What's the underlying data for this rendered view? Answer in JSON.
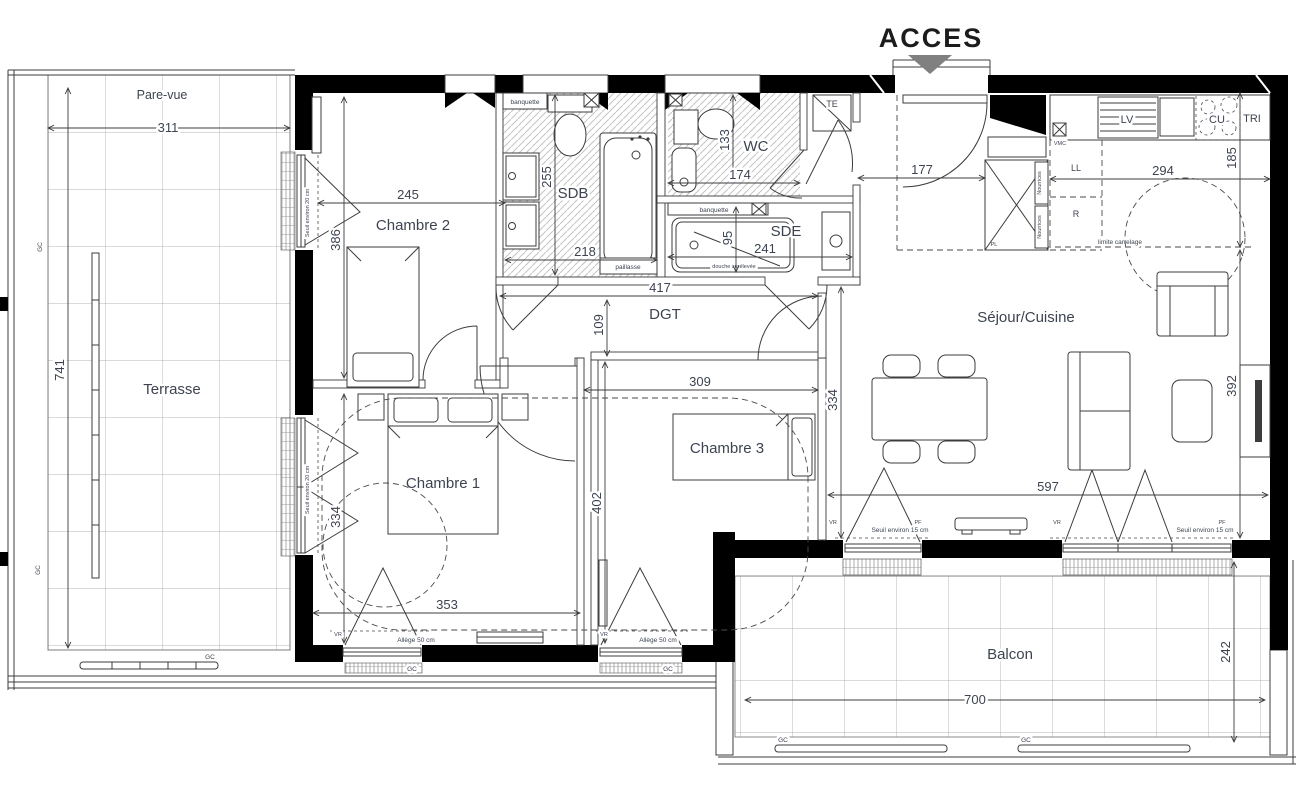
{
  "header": {
    "acces": "ACCES"
  },
  "colors": {
    "wall": "#000000",
    "text": "#3d4450",
    "access_arrow": "#808080",
    "lines": "#3c3c3c"
  },
  "rooms": {
    "pare_vue": "Pare-vue",
    "terrasse": "Terrasse",
    "chambre1": "Chambre 1",
    "chambre2": "Chambre 2",
    "chambre3": "Chambre 3",
    "sdb": "SDB",
    "wc": "WC",
    "sde": "SDE",
    "dgt": "DGT",
    "sejour": "Séjour/Cuisine",
    "balcon": "Balcon"
  },
  "kitchen": {
    "lv": "LV",
    "cu": "CU",
    "tri": "TRI",
    "ll": "LL",
    "r": "R",
    "pl": "PL",
    "te": "TE",
    "vmc": "VMC",
    "nourrices": "Nourrices",
    "limite_carrelage": "limite carrelage"
  },
  "bath": {
    "banquette": "banquette",
    "paillasse": "paillasse",
    "douche_surelevee": "douche surélevée"
  },
  "annotations": {
    "seuil_15": "Seuil environ 15 cm",
    "seuil_20": "Seuil environ 20 cm",
    "allege_50": "Allège 50 cm",
    "vr": "VR",
    "pf": "PF",
    "gc": "GC"
  },
  "dims": {
    "pare_vue_w": "311",
    "terrasse_h": "741",
    "ch2_w": "245",
    "ch2_h": "386",
    "sdb_h": "255",
    "sdb_w": "218",
    "wc_h": "133",
    "wc_w": "174",
    "entree_w": "177",
    "cuisine_w": "294",
    "cuisine_h": "185",
    "sde_h": "95",
    "sde_w": "241",
    "dgt_w": "417",
    "dgt_h": "109",
    "ch3_w": "309",
    "ch3_h": "334",
    "ch1_h": "334",
    "ch1_w": "353",
    "ch13_h": "402",
    "sejour_h": "392",
    "sejour_w": "597",
    "balcon_w": "700",
    "balcon_h": "242"
  }
}
